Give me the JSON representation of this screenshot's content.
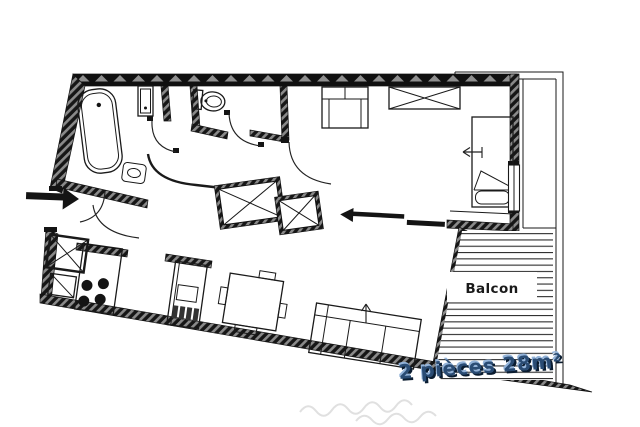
{
  "plan": {
    "balcony_label": "Balcon",
    "caption": "2 pièces 28m²"
  },
  "colors": {
    "paper": "#ffffff",
    "ink": "#1a1a1a",
    "wall-black": "#141414",
    "hatch-gray": "#8a8a8a",
    "deck-line": "#2e2e2e",
    "caption-main": "#2a4c74",
    "caption-shadow": "#0a1c30",
    "caption-highlight": "#93b3d9",
    "watermark": "#e0e0e0"
  }
}
